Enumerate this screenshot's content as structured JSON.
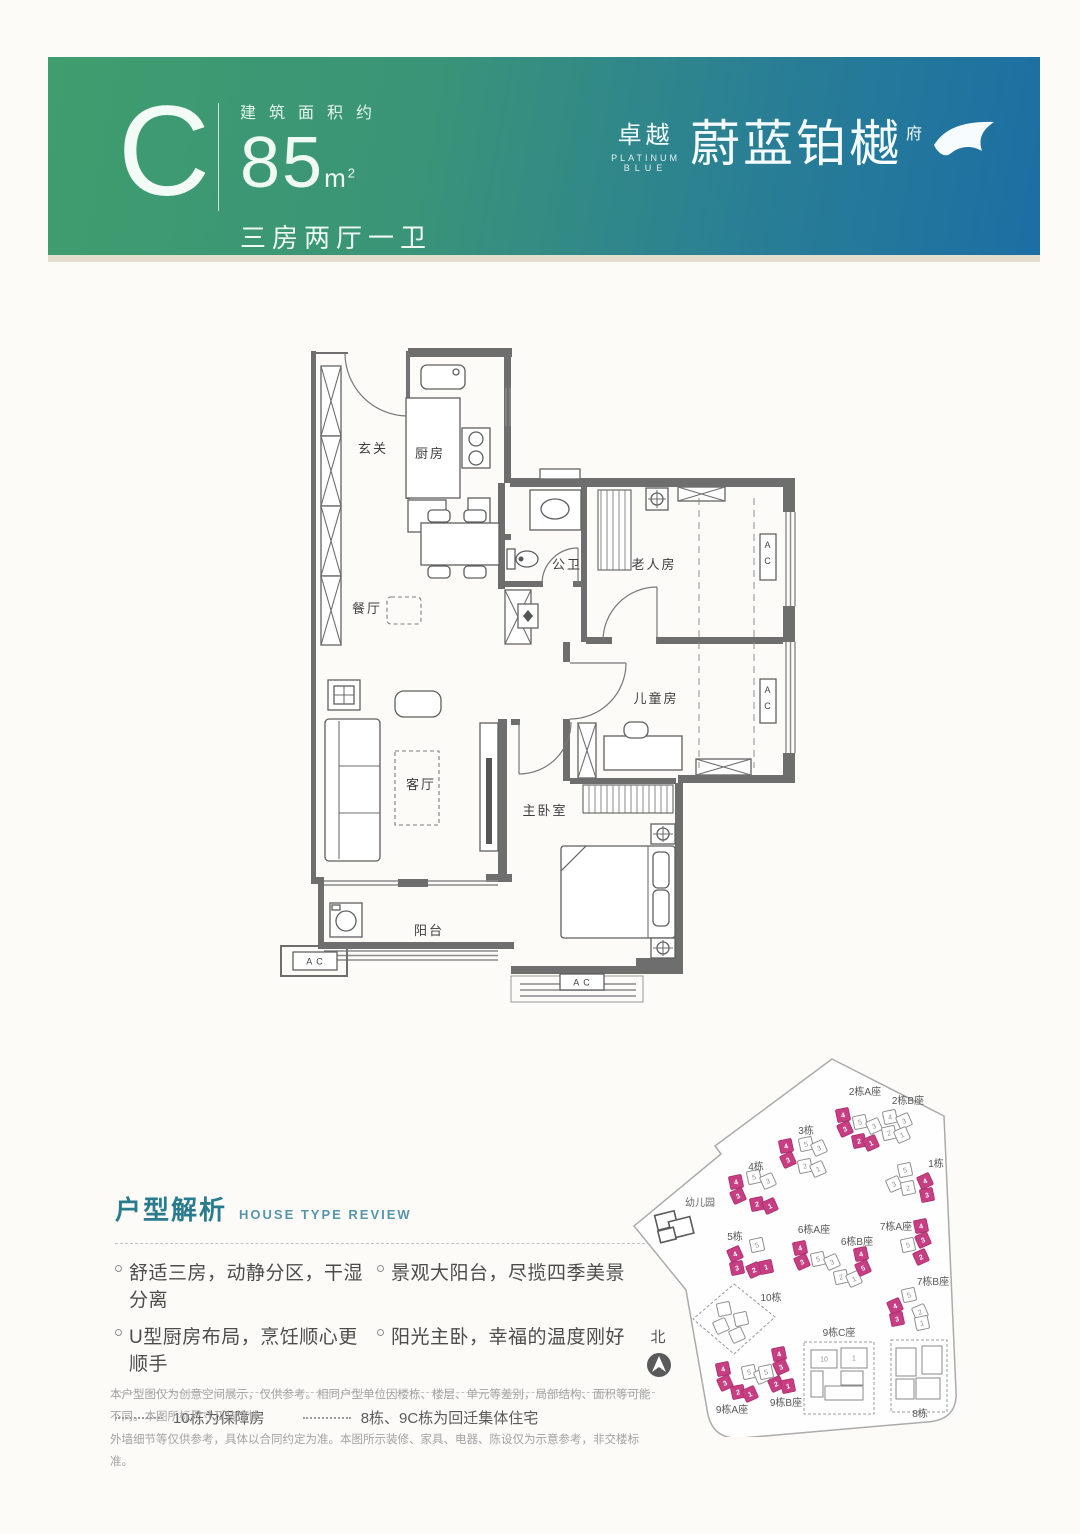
{
  "banner": {
    "unit_letter": "C",
    "area_label": "建筑面积约",
    "area_value": "85",
    "area_unit_base": "m",
    "area_unit_exp": "2",
    "layout_text": "三房两厅一卫",
    "gradient_from": "#3f9d6e",
    "gradient_to": "#1c6ea4",
    "brand": {
      "cn_small": "卓越",
      "en_line1": "PLATINUM",
      "en_line2": "BLUE",
      "cn_main": "蔚蓝铂樾",
      "cn_suffix": "府",
      "flag_icon": "whale-tail-flag-icon"
    }
  },
  "floor_plan": {
    "rooms": [
      {
        "label": "玄关",
        "x": 105,
        "y": 115
      },
      {
        "label": "厨房",
        "x": 162,
        "y": 120
      },
      {
        "label": "公卫",
        "x": 299,
        "y": 231
      },
      {
        "label": "老人房",
        "x": 386,
        "y": 231
      },
      {
        "label": "餐厅",
        "x": 99,
        "y": 275
      },
      {
        "label": "客厅",
        "x": 153,
        "y": 451
      },
      {
        "label": "儿童房",
        "x": 388,
        "y": 365
      },
      {
        "label": "主卧室",
        "x": 277,
        "y": 477
      },
      {
        "label": "阳台",
        "x": 161,
        "y": 597
      }
    ],
    "ac_text": "AC",
    "ac_units": [
      {
        "x": 492,
        "y": 196,
        "w": 16,
        "h": 46,
        "dir": "v"
      },
      {
        "x": 492,
        "y": 341,
        "w": 16,
        "h": 44,
        "dir": "v"
      },
      {
        "x": 25,
        "y": 614,
        "w": 44,
        "h": 18,
        "dir": "h"
      },
      {
        "x": 292,
        "y": 636,
        "w": 44,
        "h": 16,
        "dir": "h"
      }
    ]
  },
  "review": {
    "title_cn": "户型解析",
    "title_en": "HOUSE TYPE REVIEW",
    "bullets": [
      "舒适三房，动静分区，干湿分离",
      "景观大阳台，尽揽四季美景",
      "U型厨房布局，烹饪顺心更顺手",
      "阳光主卧，幸福的温度刚好"
    ],
    "legend": [
      {
        "label": "10栋为保障房"
      },
      {
        "label": "8栋、9C栋为回迁集体住宅"
      }
    ]
  },
  "site_plan": {
    "north_label": "北",
    "north_icon": "north-arrow-icon",
    "kindergarten_label": "幼儿园",
    "highlight_color": "#c73e82",
    "buildings": [
      {
        "name": "2栋A座",
        "lx": 237,
        "ly": 42,
        "squares": [
          [
            215,
            62,
            1,
            "4"
          ],
          [
            217,
            76,
            1,
            "3"
          ],
          [
            231,
            88,
            1,
            "2"
          ],
          [
            243,
            90,
            1,
            "1"
          ],
          [
            232,
            69,
            0,
            "5"
          ],
          [
            246,
            73,
            0,
            "3"
          ]
        ]
      },
      {
        "name": "2栋B座",
        "lx": 280,
        "ly": 51,
        "squares": [
          [
            262,
            64,
            0,
            "4"
          ],
          [
            276,
            68,
            0,
            "3"
          ],
          [
            261,
            80,
            0,
            "2"
          ],
          [
            274,
            82,
            0,
            "1"
          ]
        ]
      },
      {
        "name": "3栋",
        "lx": 178,
        "ly": 81,
        "squares": [
          [
            158,
            93,
            1,
            "4"
          ],
          [
            160,
            107,
            1,
            "3"
          ],
          [
            178,
            91,
            0,
            "5"
          ],
          [
            191,
            95,
            0,
            "3"
          ],
          [
            177,
            113,
            0,
            "2"
          ],
          [
            190,
            116,
            0,
            "1"
          ]
        ]
      },
      {
        "name": "4栋",
        "lx": 128,
        "ly": 117,
        "squares": [
          [
            108,
            129,
            1,
            "4"
          ],
          [
            110,
            143,
            1,
            "3"
          ],
          [
            126,
            124,
            0,
            "5"
          ],
          [
            140,
            128,
            0,
            "3"
          ],
          [
            129,
            151,
            1,
            "2"
          ],
          [
            142,
            153,
            1,
            "1"
          ]
        ]
      },
      {
        "name": "1栋",
        "lx": 308,
        "ly": 114,
        "squares": [
          [
            277,
            117,
            0,
            "5"
          ],
          [
            266,
            131,
            0,
            "3"
          ],
          [
            280,
            135,
            0,
            "2"
          ],
          [
            297,
            128,
            1,
            "4"
          ],
          [
            299,
            142,
            1,
            "3"
          ]
        ]
      },
      {
        "name": "5栋",
        "lx": 107,
        "ly": 187,
        "squares": [
          [
            129,
            192,
            0,
            "5"
          ],
          [
            107,
            201,
            1,
            "4"
          ],
          [
            109,
            215,
            1,
            "3"
          ],
          [
            126,
            217,
            1,
            "2"
          ],
          [
            138,
            214,
            1,
            "1"
          ]
        ]
      },
      {
        "name": "6栋A座",
        "lx": 186,
        "ly": 180,
        "squares": [
          [
            172,
            195,
            1,
            "4"
          ],
          [
            174,
            209,
            1,
            "3"
          ],
          [
            190,
            206,
            0,
            "5"
          ],
          [
            204,
            209,
            0,
            "3"
          ],
          [
            213,
            224,
            0,
            "2"
          ],
          [
            226,
            226,
            0,
            "1"
          ]
        ]
      },
      {
        "name": "6栋B座",
        "lx": 229,
        "ly": 192,
        "squares": [
          [
            233,
            201,
            1,
            "4"
          ],
          [
            235,
            215,
            1,
            "5"
          ]
        ]
      },
      {
        "name": "7栋A座",
        "lx": 268,
        "ly": 177,
        "squares": [
          [
            293,
            173,
            1,
            "4"
          ],
          [
            295,
            187,
            1,
            "3"
          ],
          [
            280,
            192,
            0,
            "5"
          ],
          [
            293,
            204,
            1,
            "2"
          ]
        ]
      },
      {
        "name": "7栋B座",
        "lx": 305,
        "ly": 232,
        "squares": [
          [
            281,
            242,
            0,
            "5"
          ],
          [
            267,
            253,
            1,
            "4"
          ],
          [
            269,
            266,
            1,
            "3"
          ],
          [
            292,
            259,
            0,
            "2"
          ],
          [
            294,
            270,
            0,
            "1"
          ]
        ]
      },
      {
        "name": "10栋",
        "lx": 143,
        "ly": 248,
        "dash_diamond": "106,231 147,264 106,301 65,266",
        "squares": [
          [
            96,
            256,
            0,
            ""
          ],
          [
            93,
            273,
            0,
            ""
          ],
          [
            113,
            266,
            0,
            ""
          ],
          [
            109,
            282,
            0,
            ""
          ]
        ]
      },
      {
        "name": "9栋A座",
        "lx": 104,
        "ly": 360,
        "squares": [
          [
            95,
            316,
            1,
            "4"
          ],
          [
            97,
            330,
            1,
            "3"
          ],
          [
            110,
            339,
            1,
            "2"
          ],
          [
            122,
            341,
            1,
            "1"
          ],
          [
            121,
            319,
            0,
            "5"
          ],
          [
            134,
            323,
            0,
            "3"
          ]
        ]
      },
      {
        "name": "9栋B座",
        "lx": 158,
        "ly": 353,
        "squares": [
          [
            151,
            301,
            1,
            "4"
          ],
          [
            153,
            314,
            1,
            "3"
          ],
          [
            138,
            319,
            0,
            "5"
          ],
          [
            148,
            331,
            1,
            "2"
          ],
          [
            160,
            333,
            1,
            "1"
          ]
        ]
      },
      {
        "name": "9栋C座",
        "lx": 211,
        "ly": 283,
        "dash_rect": [
          176,
          289,
          70,
          72
        ],
        "inner": [
          [
            183,
            297,
            26,
            18,
            "10"
          ],
          [
            213,
            295,
            26,
            20,
            "1"
          ],
          [
            213,
            318,
            22,
            14,
            ""
          ],
          [
            183,
            318,
            12,
            26,
            ""
          ],
          [
            197,
            333,
            38,
            14,
            ""
          ]
        ]
      },
      {
        "name": "8栋",
        "lx": 292,
        "ly": 364,
        "dash_rect": [
          263,
          287,
          56,
          72
        ],
        "inner": [
          [
            268,
            295,
            20,
            28,
            ""
          ],
          [
            294,
            293,
            20,
            28,
            ""
          ],
          [
            268,
            326,
            18,
            20,
            ""
          ],
          [
            288,
            325,
            24,
            21,
            ""
          ]
        ]
      }
    ]
  },
  "disclaimer": {
    "lines": [
      "本户型图仅为创意空间展示，仅供参考。相同户型单位因楼栋、楼层、单元等差别，局部结构、面积等可能不同。本图所标尺寸及装饰性",
      "外墙细节等仅供参考，具体以合同约定为准。本图所示装修、家具、电器、陈设仅为示意参考，非交楼标准。"
    ]
  }
}
